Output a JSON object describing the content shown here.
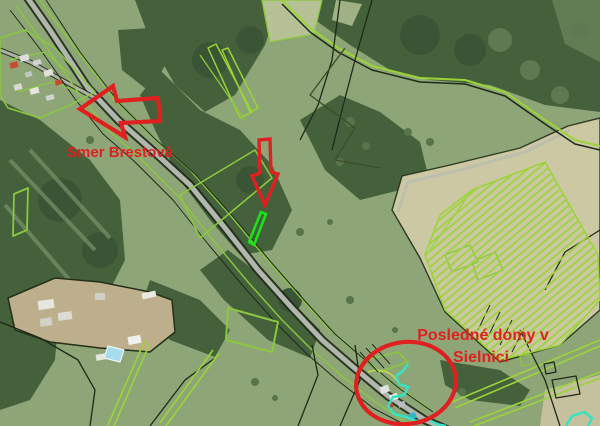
{
  "map": {
    "annotations": {
      "direction_label": "Smer Brestová",
      "houses_label_line1": "Posledné domy v",
      "houses_label_line2": "Sielnici"
    },
    "palette": {
      "annotation-red": "#e02020",
      "selected-cyan": "#35e2c3",
      "highlight-green": "#1ae519",
      "parcel-green": "#8ac83e",
      "parcel-green-bright": "#9ad437",
      "boundary-dark": "#1e2a18",
      "road-grey": "#b2b7ad",
      "meadow-green": "#8ea677",
      "forest-green": "#45613c",
      "field-pale": "#ccc8a4"
    }
  }
}
